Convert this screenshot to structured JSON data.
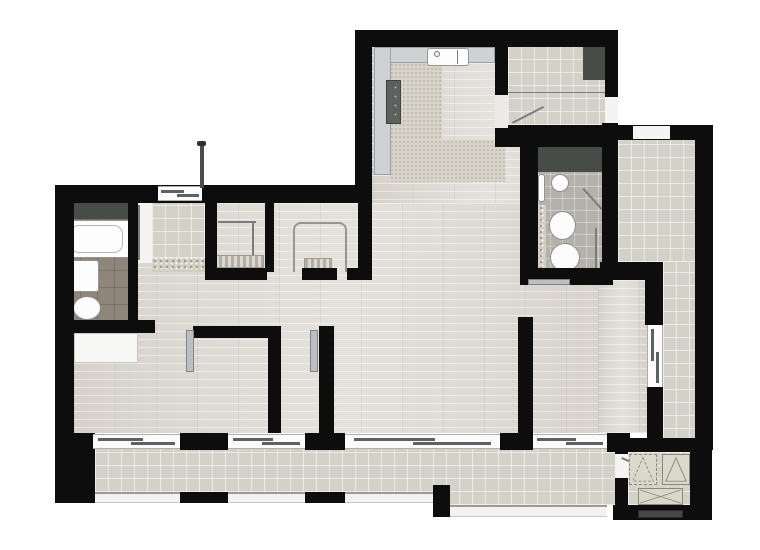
{
  "meta": {
    "canvas_width": 760,
    "canvas_height": 550,
    "kind": "apartment-floor-plan",
    "visible_text": ""
  },
  "palette": {
    "wall": "#0d0d0d",
    "wood_floor": "#dedad4",
    "tile_floor": "#d4d1c8",
    "bath_tile_light": "#b4b1aa",
    "bath_tile_dark": "#8e857b",
    "kitchen_floor": "#d8d4ca",
    "counter": "#ced2d4",
    "closet_dark": "#474c49",
    "fixture_white": "#fdfdfd",
    "window_frame": "#aeaeae",
    "window_sash": "#5d6164",
    "background": "#ffffff"
  },
  "rooms": [
    {
      "name": "kitchen"
    },
    {
      "name": "entry-hall"
    },
    {
      "name": "living-room"
    },
    {
      "name": "bathroom-left"
    },
    {
      "name": "bathroom-right"
    },
    {
      "name": "laundry"
    },
    {
      "name": "walk-in-closet-1"
    },
    {
      "name": "walk-in-closet-2"
    },
    {
      "name": "bedroom-1"
    },
    {
      "name": "bedroom-2"
    },
    {
      "name": "loggia"
    },
    {
      "name": "terrace"
    },
    {
      "name": "storage-utility"
    }
  ],
  "elements": [
    {
      "name": "floor-main-wood",
      "type": "wood",
      "x": 74,
      "y": 203,
      "w": 528,
      "h": 230
    },
    {
      "name": "floor-upper-wood",
      "type": "wood",
      "x": 372,
      "y": 47,
      "w": 230,
      "h": 156
    },
    {
      "name": "floor-living-east-wood",
      "type": "wood",
      "x": 598,
      "y": 280,
      "w": 49,
      "h": 153
    },
    {
      "name": "kitchen-floor-strip-v",
      "type": "speckle",
      "x": 390,
      "y": 63,
      "w": 52,
      "h": 117
    },
    {
      "name": "kitchen-floor-strip-h",
      "type": "speckle",
      "x": 390,
      "y": 140,
      "w": 115,
      "h": 42
    },
    {
      "name": "kitchen-counter-top",
      "type": "counter",
      "x": 374,
      "y": 47,
      "w": 121,
      "h": 16
    },
    {
      "name": "kitchen-counter-left",
      "type": "counter",
      "x": 374,
      "y": 47,
      "w": 17,
      "h": 128
    },
    {
      "name": "cooktop",
      "type": "cooktop",
      "x": 386,
      "y": 80,
      "w": 15,
      "h": 44
    },
    {
      "name": "cooktop-knob-1",
      "type": "dot",
      "x": 394,
      "y": 86,
      "w": 3,
      "h": 3
    },
    {
      "name": "cooktop-knob-2",
      "type": "dot",
      "x": 394,
      "y": 95,
      "w": 3,
      "h": 3
    },
    {
      "name": "cooktop-knob-3",
      "type": "dot",
      "x": 394,
      "y": 104,
      "w": 3,
      "h": 3
    },
    {
      "name": "cooktop-knob-4",
      "type": "dot",
      "x": 394,
      "y": 113,
      "w": 3,
      "h": 3
    },
    {
      "name": "kitchen-sink",
      "type": "fix",
      "x": 427,
      "y": 48,
      "w": 42,
      "h": 18
    },
    {
      "name": "sink-divider-line",
      "type": "line",
      "x1": 458,
      "y1": 50,
      "x2": 458,
      "y2": 64,
      "th": 1
    },
    {
      "name": "sink-faucet",
      "type": "dot",
      "x": 434,
      "y": 51,
      "w": 6,
      "h": 6
    },
    {
      "name": "entry-floor-tile",
      "type": "tile",
      "x": 508,
      "y": 47,
      "w": 97,
      "h": 78
    },
    {
      "name": "entry-floor-divider-line",
      "type": "line",
      "x1": 508,
      "y1": 92,
      "x2": 605,
      "y2": 92,
      "th": 1
    },
    {
      "name": "entry-closet",
      "type": "dark",
      "x": 583,
      "y": 45,
      "w": 22,
      "h": 35
    },
    {
      "name": "entry-door-swing-line",
      "type": "line",
      "x1": 512,
      "y1": 122,
      "x2": 543,
      "y2": 106,
      "th": 2
    },
    {
      "name": "loggia-floor-tile",
      "type": "tile",
      "x": 618,
      "y": 140,
      "w": 77,
      "h": 122
    },
    {
      "name": "loggia-floor-tile-south",
      "type": "tile",
      "x": 663,
      "y": 262,
      "w": 32,
      "h": 180
    },
    {
      "name": "bath2-closet",
      "type": "dark",
      "x": 538,
      "y": 147,
      "w": 64,
      "h": 25
    },
    {
      "name": "bath2-floor-tile",
      "type": "btile",
      "x": 538,
      "y": 172,
      "w": 64,
      "h": 111
    },
    {
      "name": "bath2-mosaic-strip",
      "type": "mosaic",
      "x": 538,
      "y": 205,
      "w": 8,
      "h": 78
    },
    {
      "name": "bath2-towel-rail",
      "type": "fix",
      "x": 538,
      "y": 174,
      "w": 7,
      "h": 28
    },
    {
      "name": "bath2-washbasin",
      "type": "oval",
      "x": 551,
      "y": 174,
      "w": 18,
      "h": 18
    },
    {
      "name": "bath2-bidet",
      "type": "oval",
      "x": 549,
      "y": 211,
      "w": 27,
      "h": 29
    },
    {
      "name": "bath2-toilet",
      "type": "oval",
      "x": 550,
      "y": 243,
      "w": 30,
      "h": 29
    },
    {
      "name": "shower-glass-line",
      "type": "line",
      "x1": 597,
      "y1": 228,
      "x2": 597,
      "y2": 272,
      "th": 2
    },
    {
      "name": "shower-door-line",
      "type": "line",
      "x1": 584,
      "y1": 188,
      "x2": 603,
      "y2": 209,
      "th": 2
    },
    {
      "name": "bath1-niche",
      "type": "dark",
      "x": 63,
      "y": 203,
      "w": 67,
      "h": 16
    },
    {
      "name": "bath1-floor-tile",
      "type": "btiled",
      "x": 63,
      "y": 219,
      "w": 70,
      "h": 103
    },
    {
      "name": "bath1-mosaic-strip",
      "type": "mosaic",
      "x": 63,
      "y": 219,
      "w": 8,
      "h": 103
    },
    {
      "name": "bathtub",
      "type": "fix",
      "x": 64,
      "y": 220,
      "w": 66,
      "h": 38
    },
    {
      "name": "bathtub-inner",
      "type": "inner",
      "x": 70,
      "y": 225,
      "w": 53,
      "h": 28
    },
    {
      "name": "bath1-washbasin",
      "type": "fix",
      "x": 71,
      "y": 260,
      "w": 28,
      "h": 32
    },
    {
      "name": "bath1-toilet",
      "type": "oval",
      "x": 73,
      "y": 296,
      "w": 28,
      "h": 24
    },
    {
      "name": "laundry-floor-tile",
      "type": "tile",
      "x": 152,
      "y": 203,
      "w": 53,
      "h": 55
    },
    {
      "name": "laundry-mosaic-strip",
      "type": "mosaic",
      "x": 152,
      "y": 258,
      "w": 53,
      "h": 14
    },
    {
      "name": "closet1-rail-line-h",
      "type": "line",
      "x1": 218,
      "y1": 221,
      "x2": 256,
      "y2": 221,
      "th": 2
    },
    {
      "name": "closet1-rail-line-v",
      "type": "line",
      "x1": 254,
      "y1": 221,
      "x2": 254,
      "y2": 267,
      "th": 2
    },
    {
      "name": "closet1-shelf-stripes",
      "type": "stripes",
      "x": 212,
      "y": 255,
      "w": 52,
      "h": 13
    },
    {
      "name": "closet2-ushelf",
      "type": "ushelf",
      "x": 293,
      "y": 222,
      "w": 54,
      "h": 50
    },
    {
      "name": "closet2-shelf-stripes",
      "type": "stripes",
      "x": 304,
      "y": 258,
      "w": 28,
      "h": 14
    },
    {
      "name": "terrace-floor-tile",
      "type": "tile",
      "x": 95,
      "y": 448,
      "w": 338,
      "h": 44
    },
    {
      "name": "terrace-floor-tile-deep",
      "type": "tile",
      "x": 433,
      "y": 448,
      "w": 182,
      "h": 57
    },
    {
      "name": "storage-floor-tile",
      "type": "tile",
      "x": 628,
      "y": 452,
      "w": 62,
      "h": 53
    },
    {
      "name": "wall-upper-top",
      "type": "wall",
      "x": 355,
      "y": 30,
      "w": 260,
      "h": 17
    },
    {
      "name": "wall-upper-left",
      "type": "wall",
      "x": 355,
      "y": 30,
      "w": 17,
      "h": 173
    },
    {
      "name": "wall-upper-right",
      "type": "wall",
      "x": 605,
      "y": 30,
      "w": 13,
      "h": 67
    },
    {
      "name": "wall-right-mid",
      "type": "wall",
      "x": 602,
      "y": 123,
      "w": 16,
      "h": 145
    },
    {
      "name": "wall-kitchen-divider",
      "type": "wall",
      "x": 495,
      "y": 47,
      "w": 13,
      "h": 48
    },
    {
      "name": "wall-bath2-top",
      "type": "wall",
      "x": 495,
      "y": 125,
      "w": 123,
      "h": 22
    },
    {
      "name": "wall-bath2-left",
      "type": "wall",
      "x": 520,
      "y": 147,
      "w": 18,
      "h": 136
    },
    {
      "name": "wall-bath2-bottom",
      "type": "wall",
      "x": 520,
      "y": 268,
      "w": 93,
      "h": 17
    },
    {
      "name": "wall-leftwing-top",
      "type": "wall",
      "x": 55,
      "y": 185,
      "w": 317,
      "h": 18
    },
    {
      "name": "wall-left-outer",
      "type": "wall",
      "x": 55,
      "y": 185,
      "w": 19,
      "h": 282
    },
    {
      "name": "wall-corner-bottom-left",
      "type": "wall",
      "x": 55,
      "y": 433,
      "w": 40,
      "h": 70
    },
    {
      "name": "wall-bath1-right",
      "type": "wall",
      "x": 128,
      "y": 203,
      "w": 10,
      "h": 119
    },
    {
      "name": "wall-bath1-bottom",
      "type": "wall",
      "x": 55,
      "y": 320,
      "w": 100,
      "h": 13
    },
    {
      "name": "wall-laundry-right",
      "type": "wall",
      "x": 205,
      "y": 203,
      "w": 12,
      "h": 69
    },
    {
      "name": "wall-closet-divider",
      "type": "wall",
      "x": 265,
      "y": 203,
      "w": 9,
      "h": 69
    },
    {
      "name": "wall-closet2-right",
      "type": "wall",
      "x": 358,
      "y": 203,
      "w": 14,
      "h": 69
    },
    {
      "name": "wall-closets-bottom-a",
      "type": "wall",
      "x": 205,
      "y": 268,
      "w": 62,
      "h": 12
    },
    {
      "name": "wall-closets-bottom-b",
      "type": "wall",
      "x": 302,
      "y": 268,
      "w": 35,
      "h": 12
    },
    {
      "name": "wall-closets-bottom-c",
      "type": "wall",
      "x": 347,
      "y": 268,
      "w": 25,
      "h": 12
    },
    {
      "name": "wall-bedroom1-top",
      "type": "wall",
      "x": 193,
      "y": 326,
      "w": 88,
      "h": 12
    },
    {
      "name": "wall-bedroom-divider-a",
      "type": "wall",
      "x": 268,
      "y": 326,
      "w": 13,
      "h": 107
    },
    {
      "name": "wall-bedroom-divider-b",
      "type": "wall",
      "x": 319,
      "y": 326,
      "w": 15,
      "h": 107
    },
    {
      "name": "wall-living-divider",
      "type": "wall",
      "x": 518,
      "y": 317,
      "w": 15,
      "h": 116
    },
    {
      "name": "wall-window-stub-1",
      "type": "wall",
      "x": 180,
      "y": 433,
      "w": 48,
      "h": 17
    },
    {
      "name": "wall-window-stub-2",
      "type": "wall",
      "x": 305,
      "y": 433,
      "w": 40,
      "h": 17
    },
    {
      "name": "wall-window-stub-3",
      "type": "wall",
      "x": 500,
      "y": 433,
      "w": 33,
      "h": 17
    },
    {
      "name": "wall-corner-bottom-right",
      "type": "wall",
      "x": 607,
      "y": 433,
      "w": 23,
      "h": 19
    },
    {
      "name": "wall-storage-left",
      "type": "wall",
      "x": 615,
      "y": 452,
      "w": 13,
      "h": 68
    },
    {
      "name": "wall-loggia-top",
      "type": "wall",
      "x": 613,
      "y": 125,
      "w": 82,
      "h": 15
    },
    {
      "name": "wall-right-outer",
      "type": "wall",
      "x": 695,
      "y": 125,
      "w": 18,
      "h": 325
    },
    {
      "name": "wall-loggia-mid",
      "type": "wall",
      "x": 600,
      "y": 262,
      "w": 63,
      "h": 18
    },
    {
      "name": "wall-loggia-a",
      "type": "wall",
      "x": 645,
      "y": 280,
      "w": 18,
      "h": 45
    },
    {
      "name": "wall-loggia-b",
      "type": "wall",
      "x": 647,
      "y": 387,
      "w": 16,
      "h": 56
    },
    {
      "name": "wall-storage-top",
      "type": "wall",
      "x": 613,
      "y": 438,
      "w": 82,
      "h": 14
    },
    {
      "name": "wall-storage-right",
      "type": "wall",
      "x": 690,
      "y": 438,
      "w": 22,
      "h": 82
    },
    {
      "name": "wall-storage-bottom",
      "type": "wall",
      "x": 613,
      "y": 505,
      "w": 99,
      "h": 15
    },
    {
      "name": "wall-railing-stub-1",
      "type": "wall",
      "x": 180,
      "y": 492,
      "w": 48,
      "h": 11
    },
    {
      "name": "wall-railing-stub-2",
      "type": "wall",
      "x": 305,
      "y": 492,
      "w": 40,
      "h": 11
    },
    {
      "name": "wall-railing-stub-3",
      "type": "wall",
      "x": 433,
      "y": 485,
      "w": 17,
      "h": 32
    },
    {
      "name": "laundry-window",
      "type": "window-h",
      "x": 158,
      "y": 186,
      "w": 44,
      "h": 15
    },
    {
      "name": "entry-exterior-door",
      "type": "white",
      "x": 605,
      "y": 97,
      "w": 13,
      "h": 26
    },
    {
      "name": "kitchen-entry-threshold",
      "type": "whitedim",
      "x": 495,
      "y": 95,
      "w": 13,
      "h": 33
    },
    {
      "name": "loggia-top-opening",
      "type": "white",
      "x": 633,
      "y": 126,
      "w": 37,
      "h": 13
    },
    {
      "name": "bath1-door-opening",
      "type": "white",
      "x": 138,
      "y": 203,
      "w": 14,
      "h": 60
    },
    {
      "name": "bath1-door-leaf-line",
      "type": "line",
      "x1": 140,
      "y1": 205,
      "x2": 140,
      "y2": 260,
      "th": 2
    },
    {
      "name": "bedroom1-window",
      "type": "window-h",
      "x": 93,
      "y": 434,
      "w": 87,
      "h": 15
    },
    {
      "name": "hall-window",
      "type": "window-h",
      "x": 228,
      "y": 434,
      "w": 77,
      "h": 15
    },
    {
      "name": "bedroom2-window",
      "type": "window-h",
      "x": 345,
      "y": 434,
      "w": 155,
      "h": 15
    },
    {
      "name": "living-window",
      "type": "window-h",
      "x": 533,
      "y": 434,
      "w": 74,
      "h": 15
    },
    {
      "name": "loggia-sliding-door",
      "type": "window-v",
      "x": 647,
      "y": 325,
      "w": 16,
      "h": 62
    },
    {
      "name": "terrace-railing-1",
      "type": "railing",
      "x": 95,
      "y": 492,
      "w": 85,
      "h": 11
    },
    {
      "name": "terrace-railing-2",
      "type": "railing",
      "x": 228,
      "y": 492,
      "w": 77,
      "h": 11
    },
    {
      "name": "terrace-railing-3",
      "type": "railing",
      "x": 345,
      "y": 492,
      "w": 88,
      "h": 11
    },
    {
      "name": "terrace-railing-4",
      "type": "railing",
      "x": 450,
      "y": 505,
      "w": 157,
      "h": 12
    },
    {
      "name": "storage-door-opening",
      "type": "white",
      "x": 615,
      "y": 454,
      "w": 13,
      "h": 24
    },
    {
      "name": "storage-vent-grille",
      "type": "vent",
      "x": 638,
      "y": 510,
      "w": 45,
      "h": 8
    },
    {
      "name": "bedroom1-wardrobe",
      "type": "whitef",
      "x": 74,
      "y": 333,
      "w": 64,
      "h": 30
    },
    {
      "name": "bedroom1-door-leaf",
      "type": "leaf",
      "x": 186,
      "y": 330,
      "w": 8,
      "h": 42
    },
    {
      "name": "bedroom2-door-leaf",
      "type": "leaf",
      "x": 310,
      "y": 330,
      "w": 8,
      "h": 42
    },
    {
      "name": "bath2-door-leaf",
      "type": "leaf",
      "x": 528,
      "y": 279,
      "w": 42,
      "h": 6
    },
    {
      "name": "storage-door-swing-line",
      "type": "line",
      "x1": 622,
      "y1": 457,
      "x2": 652,
      "y2": 470,
      "th": 2
    },
    {
      "name": "storage-shaft-symbol-1",
      "type": "tri-dashed",
      "x": 629,
      "y": 454,
      "w": 28,
      "h": 31
    },
    {
      "name": "storage-shaft-symbol-2",
      "type": "tri-solid",
      "x": 662,
      "y": 454,
      "w": 28,
      "h": 31
    },
    {
      "name": "storage-hatch-symbol",
      "type": "xbox",
      "x": 638,
      "y": 488,
      "w": 45,
      "h": 17
    },
    {
      "name": "vent-pipe",
      "type": "pipe",
      "x": 200,
      "y": 143,
      "w": 4,
      "h": 45
    },
    {
      "name": "vent-pipe-cap",
      "type": "pipecap",
      "x": 197,
      "y": 141,
      "w": 9,
      "h": 5
    }
  ]
}
